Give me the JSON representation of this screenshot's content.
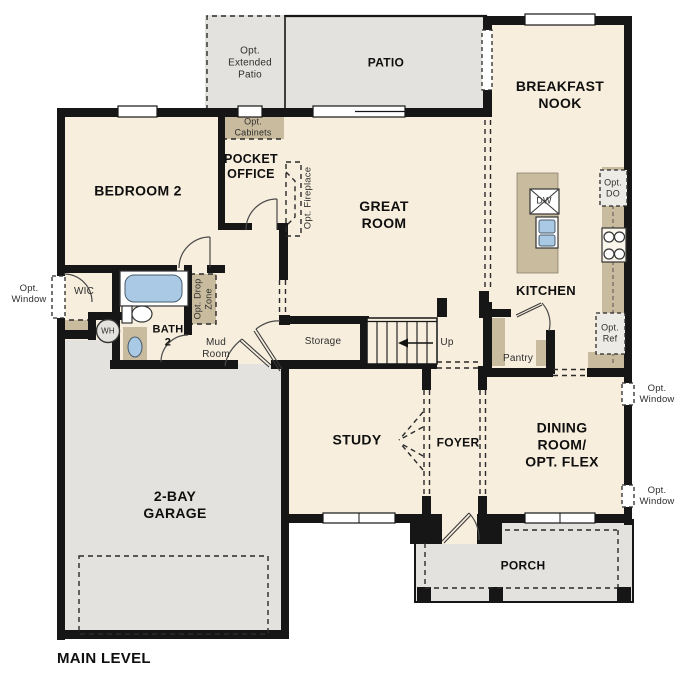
{
  "title": "MAIN LEVEL",
  "labels": {
    "patio": "PATIO",
    "opt_extended_patio": "Opt.\nExtended\nPatio",
    "breakfast_nook": "BREAKFAST\nNOOK",
    "bedroom2": "BEDROOM 2",
    "opt_cabinets": "Opt.\nCabinets",
    "pocket_office": "POCKET\nOFFICE",
    "great_room": "GREAT\nROOM",
    "opt_fireplace": "Opt. Fireplace",
    "kitchen": "KITCHEN",
    "dw": "DW",
    "opt_do": "Opt.\nDO",
    "opt_ref": "Opt.\nRef",
    "opt_window_left": "Opt.\nWindow",
    "opt_window_right_upper": "Opt.\nWindow",
    "opt_window_right_lower": "Opt.\nWindow",
    "wic": "WIC",
    "wh": "WH",
    "bath2": "BATH\n2",
    "mud_room": "Mud\nRoom",
    "opt_drop_zone": "Opt. Drop\nZone",
    "storage": "Storage",
    "up": "Up",
    "pantry": "Pantry",
    "garage": "2-BAY\nGARAGE",
    "study": "STUDY",
    "foyer": "FOYER",
    "dining_room": "DINING\nROOM/\nOPT. FLEX",
    "porch": "PORCH",
    "main_level": "MAIN LEVEL"
  },
  "colors": {
    "floor": "#f7eedd",
    "hard": "#e3e2de",
    "cab": "#c9bb9d",
    "blue": "#a9c9e5",
    "wall": "#161616"
  }
}
